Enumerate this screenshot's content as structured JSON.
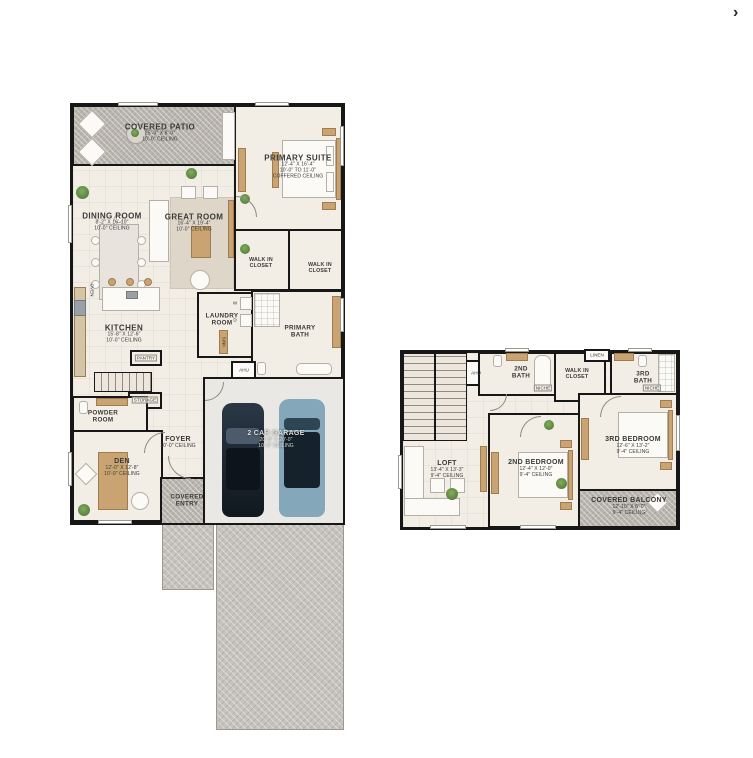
{
  "viewer": {
    "next_arrow_glyph": "›"
  },
  "colors": {
    "wall": "#171717",
    "floor": "#f2ede5",
    "patio_hatch": "#b9b5ae",
    "driveway": "#c6c3be",
    "accent_wood": "#c9a472",
    "plant_green": "#5c8a44",
    "car_dark": "#1b2633",
    "car_blue": "#7fa3b5"
  },
  "floor1": {
    "covered_patio": {
      "name": "COVERED PATIO",
      "dims": "25'-0\" X 8'-0\"",
      "ceiling": "10'-0\" CEILING"
    },
    "primary_suite": {
      "name": "PRIMARY SUITE",
      "dims": "12'-4\" X 16'-4\"",
      "ceiling": "10'-0\" TO 11'-0\"",
      "ceiling2": "COFFERED CEILING"
    },
    "dining_room": {
      "name": "DINING ROOM",
      "dims": "8'-2\" X 16'-10\"",
      "ceiling": "10'-0\" CEILING"
    },
    "great_room": {
      "name": "GREAT ROOM",
      "dims": "16'-4\" X 19'-4\"",
      "ceiling": "10'-0\" CEILING"
    },
    "walk_in_closet_a": {
      "line1": "WALK IN",
      "line2": "CLOSET"
    },
    "walk_in_closet_b": {
      "line1": "WALK IN",
      "line2": "CLOSET"
    },
    "kitchen": {
      "name": "KITCHEN",
      "dims": "15'-8\" X 12'-6\"",
      "ceiling": "10'-0\" CEILING"
    },
    "laundry_room": {
      "line1": "LAUNDRY",
      "line2": "ROOM"
    },
    "primary_bath": {
      "line1": "PRIMARY",
      "line2": "BATH"
    },
    "powder_room": {
      "line1": "POWDER",
      "line2": "ROOM"
    },
    "foyer": {
      "name": "FOYER",
      "ceiling": "10'-0\" CEILING"
    },
    "den": {
      "name": "DEN",
      "dims": "12'-0\" X 12'-8\"",
      "ceiling": "10'-0\" CEILING"
    },
    "covered_entry": {
      "line1": "COVERED",
      "line2": "ENTRY"
    },
    "garage": {
      "name": "2 CAR GARAGE",
      "dims": "20'-8\" X 20'-0\"",
      "ceiling": "10'-0\" CEILING"
    },
    "labels": {
      "oven": "OVEN",
      "pantry": "PANTRY",
      "storage": "STORAGE",
      "washer": "W",
      "dryer": "D",
      "sink": "SINK",
      "ahu": "AHU"
    }
  },
  "floor2": {
    "second_bath": {
      "line1": "2ND",
      "line2": "BATH"
    },
    "walk_in_closet": {
      "line1": "WALK IN",
      "line2": "CLOSET"
    },
    "linen": "LINEN",
    "third_bath": {
      "line1": "3RD",
      "line2": "BATH"
    },
    "ahu": "AHU",
    "niche": "NICHE",
    "loft": {
      "name": "LOFT",
      "dims": "13'-4\" X 13'-3\"",
      "ceiling": "9'-4\" CEILING"
    },
    "second_bedroom": {
      "name": "2ND BEDROOM",
      "dims": "12'-4\" X 12'-0\"",
      "ceiling": "9'-4\" CEILING"
    },
    "third_bedroom": {
      "name": "3RD BEDROOM",
      "dims": "12'-6\" X 13'-2\"",
      "ceiling": "9'-4\" CEILING"
    },
    "covered_balcony": {
      "name": "COVERED BALCONY",
      "dims": "12'-10\" X 6'-0\"",
      "ceiling": "9'-4\" CEILING"
    }
  }
}
